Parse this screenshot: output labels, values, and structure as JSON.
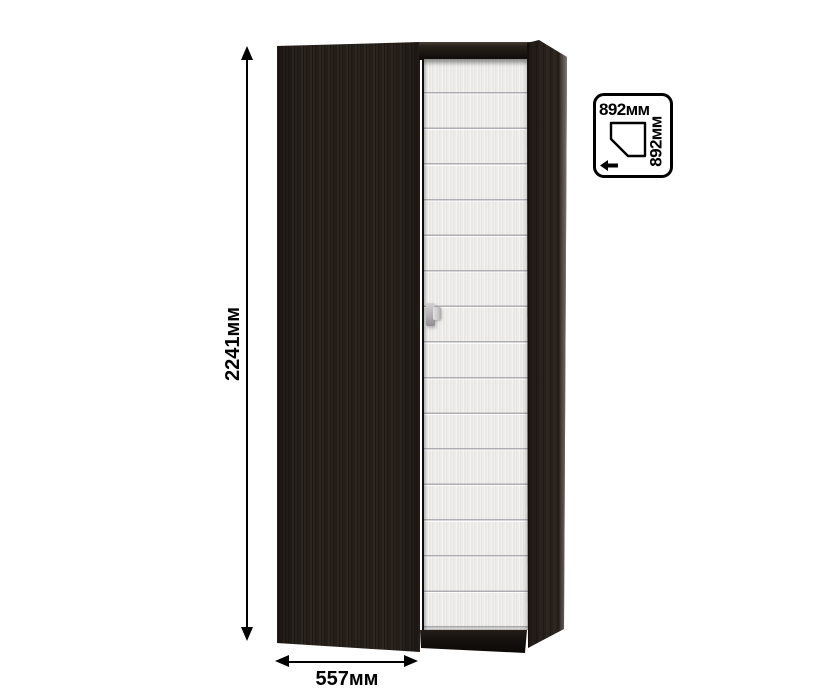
{
  "annotations": {
    "height_label": "2241мм",
    "width_label": "557мм"
  },
  "footprint_badge": {
    "top_label": "892мм",
    "side_label": "892мм",
    "shape_icon": "corner-footprint-pentagon",
    "arrow_icon": "left-arrow"
  },
  "colors": {
    "background": "#ffffff",
    "wood_dark": "#241e1a",
    "door_light": "#eeedeb",
    "annotation": "#000000",
    "handle_gray": "#b3afb2"
  }
}
